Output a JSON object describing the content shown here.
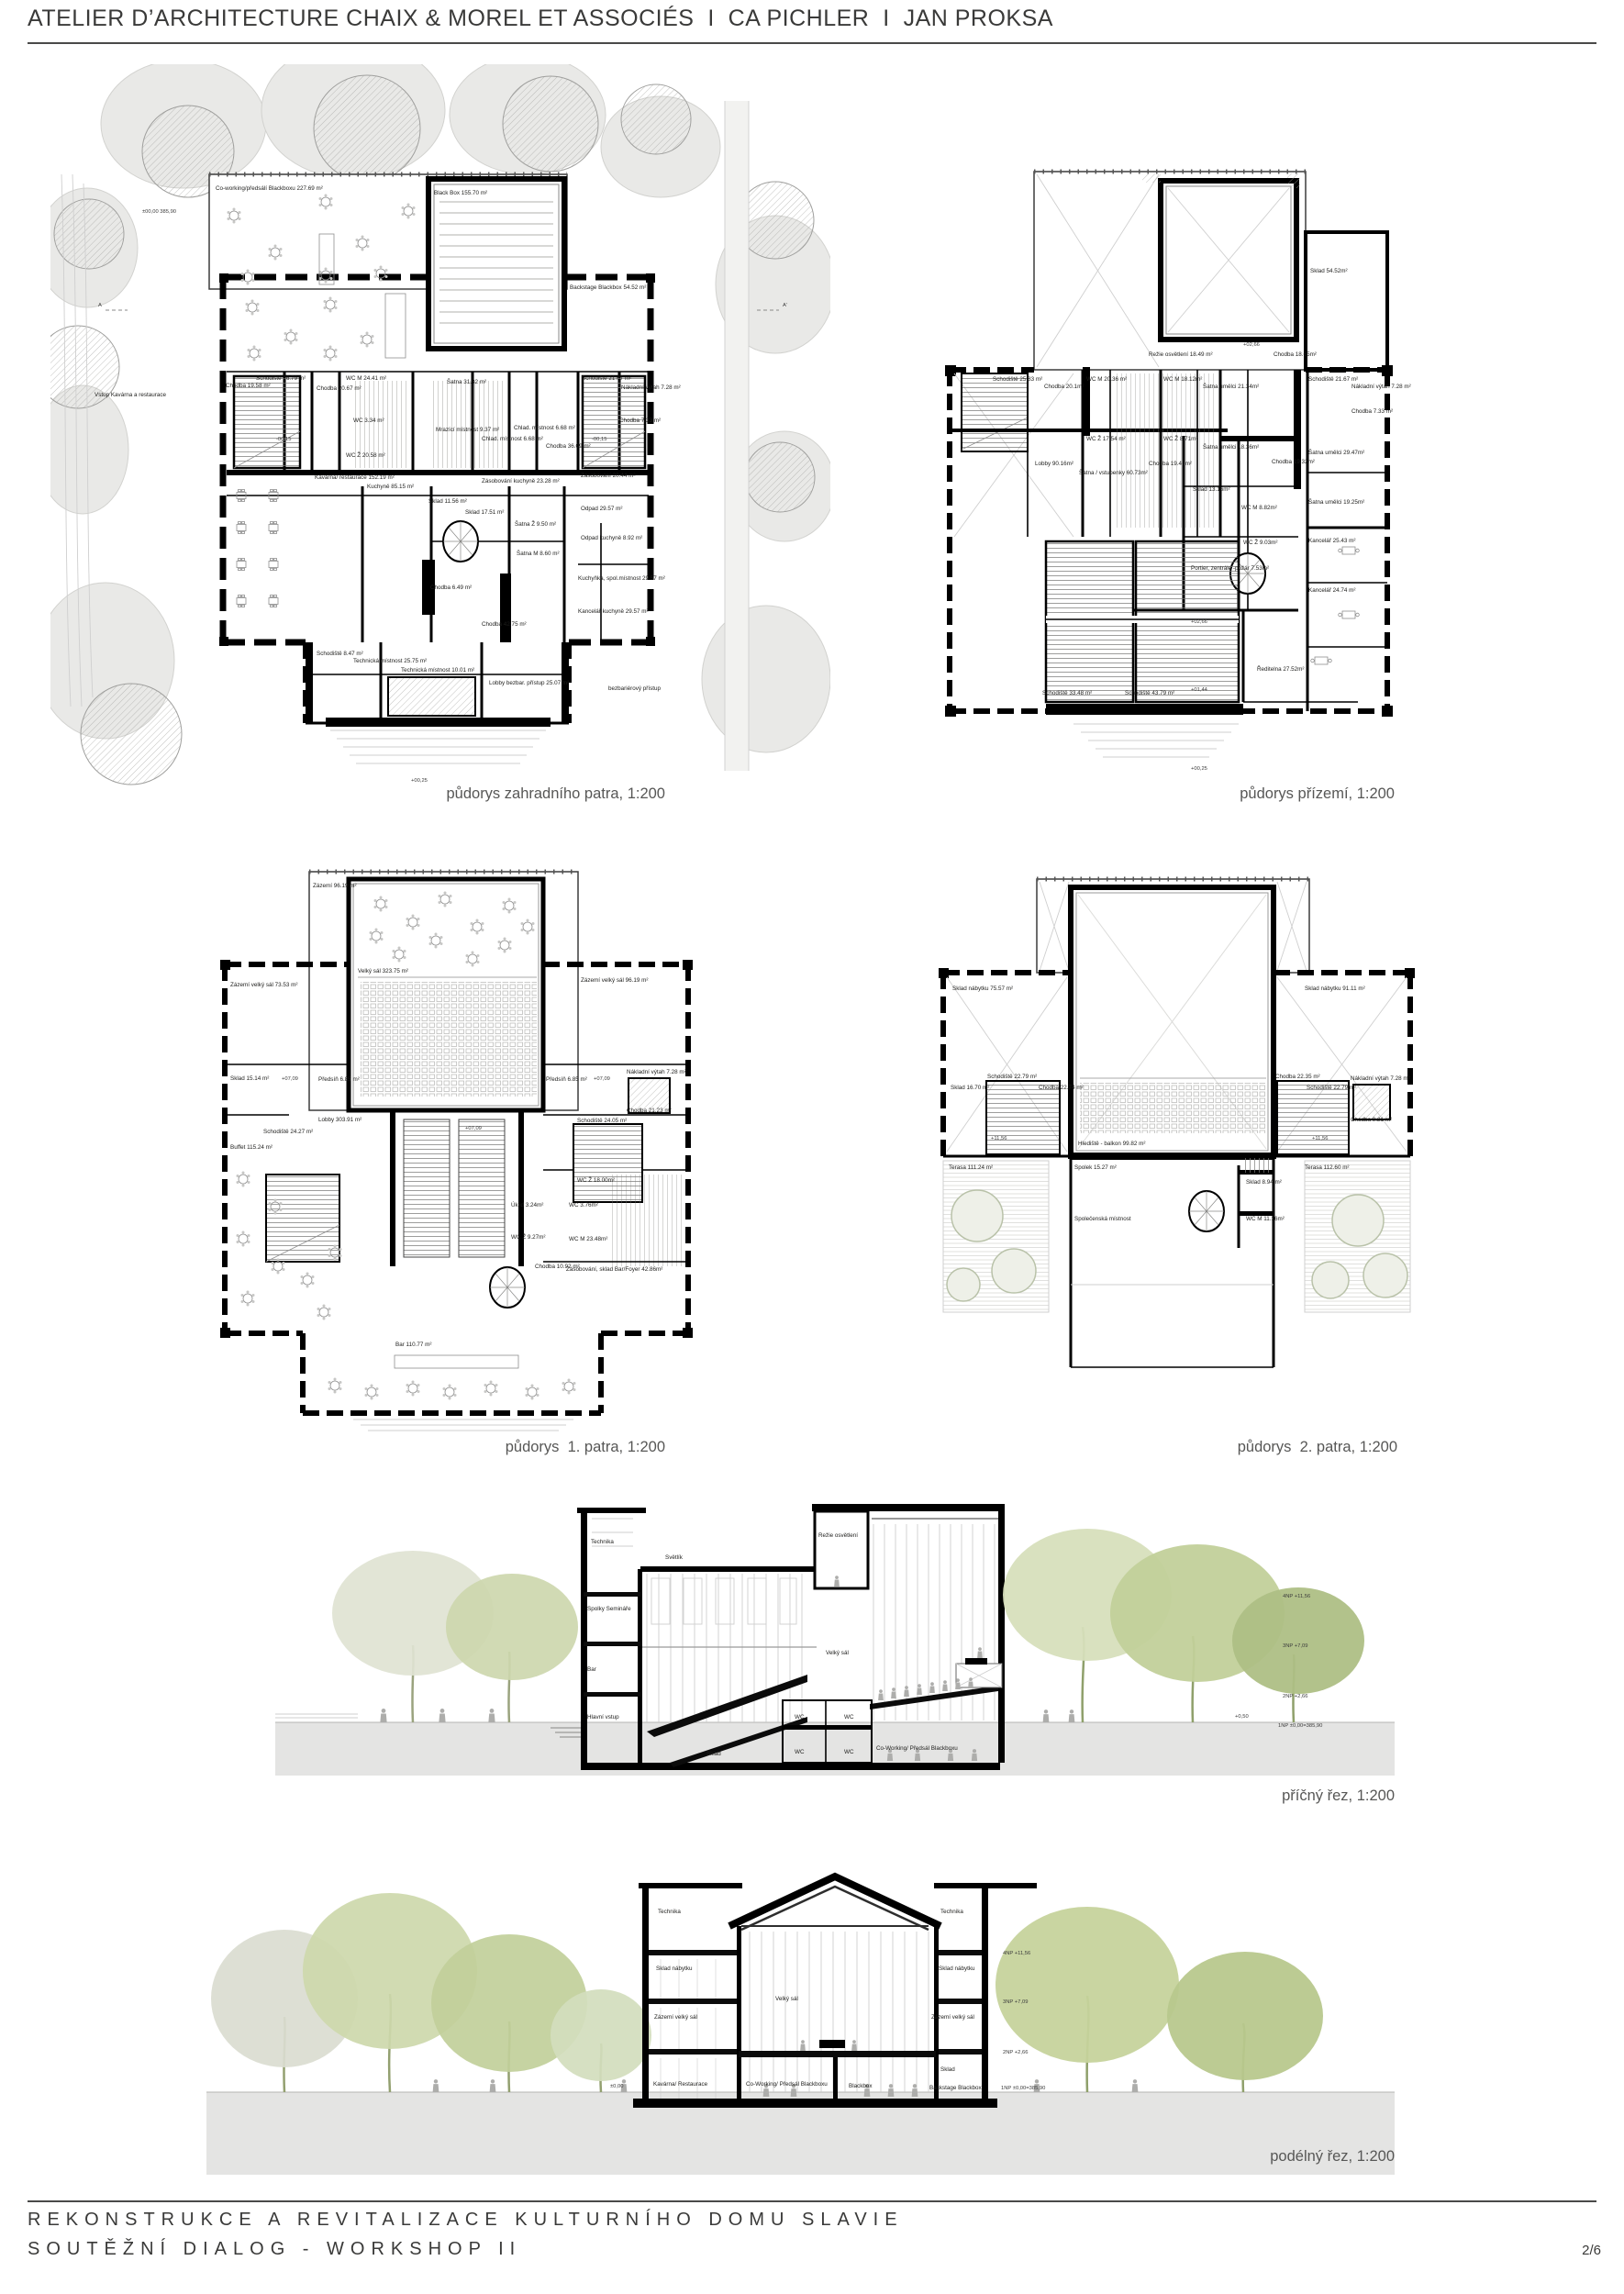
{
  "header": {
    "title": "ATELIER D’ARCHITECTURE CHAIX & MOREL ET ASSOCIÉS  I  CA PICHLER  I  JAN PROKSA"
  },
  "footer": {
    "line1": "REKONSTRUKCE A REVITALIZACE KULTURNÍHO DOMU SLAVIE",
    "line2": "SOUTĚŽNÍ DIALOG - WORKSHOP II",
    "page": "2/6"
  },
  "captions": {
    "garden": "půdorys zahradního patra, 1:200",
    "ground": "půdorys přízemí, 1:200",
    "first": "půdorys  1. patra, 1:200",
    "second": "půdorys  2. patra, 1:200",
    "cross": "příčný řez, 1:200",
    "long": "podélný řez, 1:200"
  },
  "p1": {
    "coworking": "Co-working/předsálí Blackboxu 227.69 m²",
    "blackbox": "Black Box 155.70 m²",
    "backstage": "Backstage Blackbox 54.52 m²",
    "chodba_a": "Chodba 19.58 m²",
    "schodiste_a": "Schodiště 26.79 m²",
    "chodba_b": "Chodba 20.67 m²",
    "wc_m": "WC M 24.41 m²",
    "satna": "Šatna 31.32 m²",
    "wc": "WC 3.34 m²",
    "wc_z": "WC Ž 20.58 m²",
    "mrazici": "Mrazící místnost 9.37 m²",
    "chlad_a": "Chlad. místnost 6.68 m²",
    "chlad_b": "Chlad. místnost 6.68 m²",
    "chodba_c": "Chodba 36.09 m²",
    "schodiste_b": "Schodiště 21.67 m²",
    "vytah": "Nákladní výtah 7.28 m²",
    "chodba_d": "Chodba 7.33 m²",
    "kavarna": "Kavárna/ restaurace 152.19 m²",
    "kuchyne": "Kuchyně 85.15 m²",
    "zasob_k": "Zásobování kuchyně 23.28 m²",
    "zasob": "Zásobování 20.44 m²",
    "sklad_a": "Sklad 11.56 m²",
    "sklad_b": "Sklad 17.51 m²",
    "satna_z": "Šatna Ž 9.50 m²",
    "odpad": "Odpad 29.57 m²",
    "odpad_k": "Odpad kuchyně 8.92 m²",
    "satna_m": "Šatna M 8.60 m²",
    "kuchynka": "Kuchyňka, spol.místnost 29.57 m²",
    "kancelar": "Kancelář kuchyně 29.57 m²",
    "chodba_f": "Chodba 6.49 m²",
    "chodba_e": "Chodba 42.75 m²",
    "schodiste_c": "Schodiště 8.47 m²",
    "tech_a": "Technická místnost 25.75 m²",
    "tech_b": "Technická místnost 10.01 m²",
    "lobby": "Lobby bezbar. přístup 25.07 m²",
    "bezbar": "bezbariérový přístup",
    "vstup": "Vstup Kavárna a restaurace",
    "lvl_0": "±00,00  385,90",
    "lvl_m015": "-00,15",
    "lvl_p025": "+00,25",
    "sec_a": "A",
    "sec_a2": "A'"
  },
  "p2": {
    "sklad_a": "Sklad 54.52m²",
    "rezie": "Režie osvětlení 18.49 m²",
    "chodba_a": "Chodba 18.65m²",
    "schodiste_a": "Schodiště 25.83 m²",
    "chodba_b": "Chodba 20.1m²",
    "wcm_a": "WC M 20.36 m²",
    "wcm_b": "WC M 18.12m²",
    "satna_a": "Šatna umělci 21.34m²",
    "schodiste_b": "Schodiště 21.67 m²",
    "vytah": "Nákladní výtah 7.28 m²",
    "wcz_a": "WC Ž 17.54 m²",
    "wcz_b": "WC Ž 8.71m²",
    "satna_b": "Šatna umělci 18.36m²",
    "chodba_c": "Chodba 7.33 m²",
    "satna_c": "Šatna umělci 29.47m²",
    "lobby": "Lobby 90.16m²",
    "satna_vstup": "Šatna / vstupenky 60.73m²",
    "chodba_d": "Chodba 19.41m²",
    "chodba_e": "Chodba 19.32m²",
    "sklad_b": "Sklad 13.16m²",
    "wcm_c": "WC M 8.82m²",
    "wcz_c": "WC Ž 9.03m²",
    "portier": "Portier, zentrále -požár 7.53m²",
    "satna_d": "Šatna umělci 19.25m²",
    "kancelar_a": "Kancelář 25.43 m²",
    "kancelar_b": "Kancelář 24.74 m²",
    "schodiste_c": "Schodiště 33.48 m²",
    "schodiste_d": "Schodiště 43.79 m²",
    "reditelna": "Ředitelna 27.52m²",
    "lvl_266a": "+02,66",
    "lvl_266b": "+02,66",
    "lvl_144": "+01,44",
    "lvl_0025": "+00,25"
  },
  "p3": {
    "zazemi": "Zázemí 96.19 m²",
    "velky_sal": "Velký sál 323.75 m²",
    "zazemi_vs_l": "Zázemí velký sál 73.53 m²",
    "zazemi_vs_r": "Zázemí velký sál 96.19 m²",
    "sklad": "Sklad 15.14 m²",
    "predsin_l": "Předsíň 6.85 m²",
    "predsin_r": "Předsíň 6.85 m²",
    "vytah": "Nákladní výtah 7.28 m²",
    "schodiste_l": "Schodiště 24.27 m²",
    "schodiste_r": "Schodiště 24.05 m²",
    "chodba": "Chodba 21.23 m²",
    "buffet": "Buffet 115.24 m²",
    "lobby": "Lobby 303.91 m²",
    "bar": "Bar 110.77 m²",
    "uklid": "Úklid 3.24m²",
    "wcz_s": "WC Ž 9.27m²",
    "chodba_b": "Chodba 10.92 m²",
    "wcz": "WC Ž 18.00m²",
    "wc": "WC 3.76m²",
    "wcm": "WC M 23.48m²",
    "zasobovani": "Zásobování, sklad Bar/Foyer 42.86m²",
    "lvl_709a": "+07,09",
    "lvl_709b": "+07,09",
    "lvl_709c": "+07,09"
  },
  "p4": {
    "sklad_nab_l": "Sklad nábytku 75.57 m²",
    "sklad_nab_r": "Sklad nábytku 91.11 m²",
    "sklad_l": "Sklad 16.70 m²",
    "schodiste_l": "Schodiště 22.79 m²",
    "chodba_l": "Chodba 22.74 m²",
    "chodba_r": "Chodba 22.35 m²",
    "schodiste_r": "Schodiště 22.79 m²",
    "vytah": "Nákladní výtah 7.28 m²",
    "chodba_r2": "Chodba 9.21 m²",
    "hlediste": "Hlediště - balkon 99.82 m²",
    "terasa_l": "Terasa 111.24 m²",
    "terasa_r": "Terasa 112.60 m²",
    "spolek": "Spolek 15.27 m²",
    "sklad_c": "Sklad 8.94 m²",
    "wcm": "WC M 11.16m²",
    "spolecenska": "Společenská místnost",
    "lvl_1156_l": "+11,56",
    "lvl_1156_r": "+11,56"
  },
  "s1": {
    "technika": "Technika",
    "svetlik": "Světlík",
    "rezie": "Režie osvětlení",
    "spolky": "Spolky Semináře",
    "bar": "Bar",
    "velky_sal": "Velký sál",
    "hlavni_vstup": "Hlavní vstup",
    "sklad": "Sklad",
    "wc": "WC",
    "coworking": "Co-Working/ Předsál Blackboxu",
    "lvl4": "4NP +11,56",
    "lvl3": "3NP +7,09",
    "lvl2": "2NP +2,66",
    "lvl1": "1NP ±0,00=385,90",
    "lvl_050": "+0,50"
  },
  "s2": {
    "technika": "Technika",
    "sklad_nabytku": "Sklad nábytku",
    "zazemi": "Zázemí velký sál",
    "velky_sal": "Velký sál",
    "kavarna": "Kavárna/ Restaurace",
    "coworking": "Co-Working/ Předsál Blackboxu",
    "blackbox": "Blackbox",
    "sklad": "Sklad",
    "backstage": "Backstage Blackbox",
    "lvl0": "±0,00",
    "lvl4": "4NP +11,56",
    "lvl3": "3NP +7,09",
    "lvl2": "2NP +2,66",
    "lvl1": "1NP ±0,00=385,90"
  }
}
